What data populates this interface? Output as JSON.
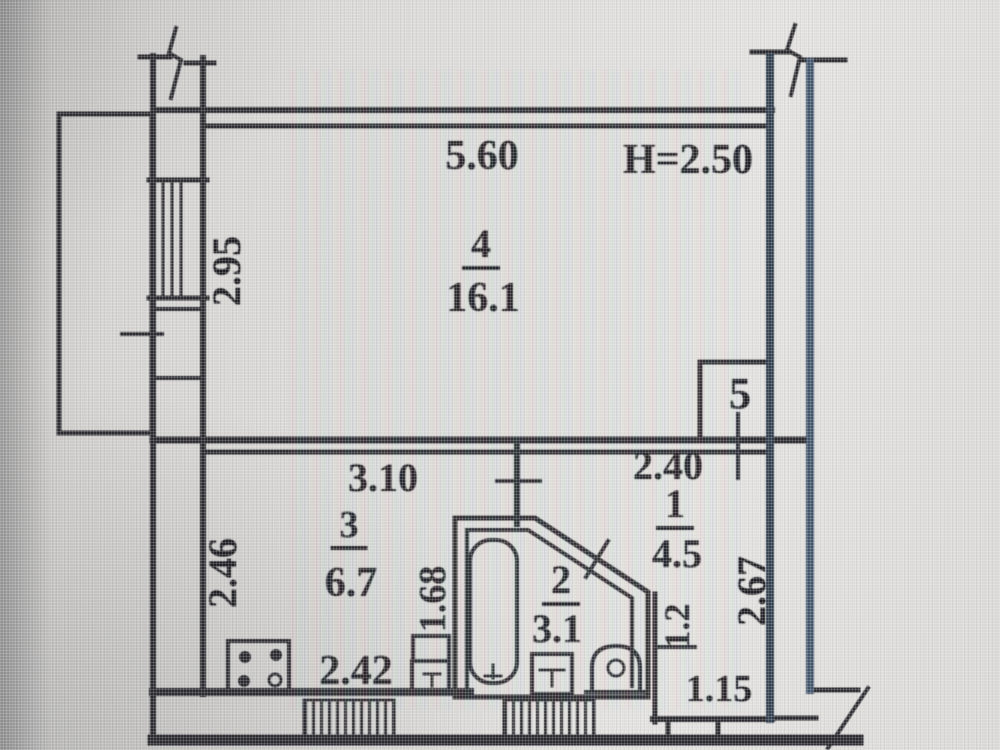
{
  "plan": {
    "rooms": {
      "living": {
        "number": "4",
        "area": "16.1"
      },
      "kitchen": {
        "number": "3",
        "area": "6.7"
      },
      "bathroom": {
        "number": "2",
        "area": "3.1"
      },
      "hall": {
        "number": "1",
        "area": "4.5"
      },
      "closet": {
        "number": "5"
      }
    },
    "dimensions": {
      "top_width": "5.60",
      "ceiling_height": "H=2.50",
      "window_left": "2.95",
      "kitchen_width": "3.10",
      "hall_width": "2.40",
      "kitchen_depth": "2.46",
      "kitchen_inner_width": "2.42",
      "partition_length": "1.68",
      "hall_depth": "2.67",
      "niche_depth": "1.2",
      "niche_width": "1.15"
    },
    "fixtures": [
      "bathtub",
      "washbasin",
      "toilet",
      "stove",
      "kitchen-sink"
    ],
    "colors": {
      "ink": "#2b2b30",
      "outer_wall": "#44576d",
      "paper": "#d9d8d6"
    }
  }
}
